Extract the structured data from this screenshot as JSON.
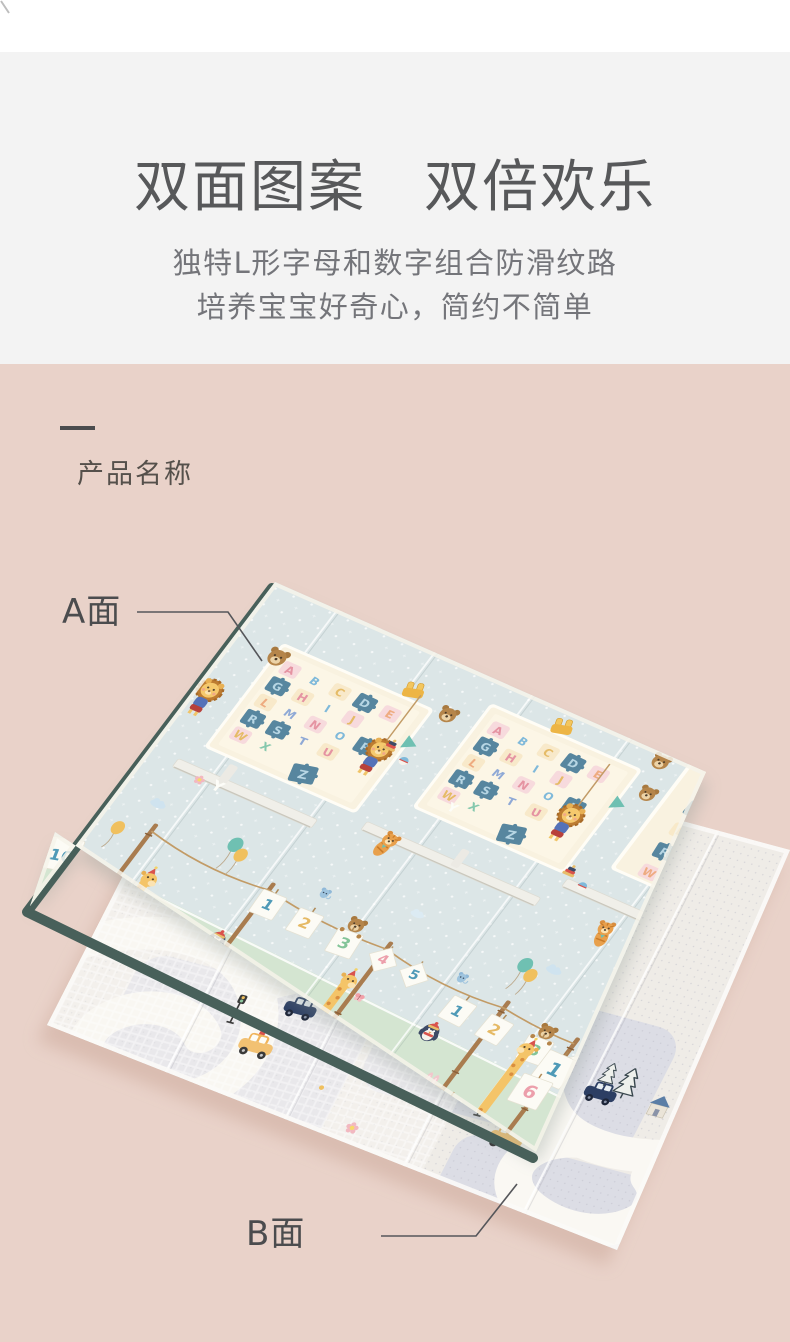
{
  "colors": {
    "page_top": "#ffffff",
    "band_gray": "#f3f3f3",
    "band_pink": "#e9d2c9",
    "title_text": "#57585a",
    "subtitle_text": "#74757a",
    "section_text": "#55504b",
    "label_text": "#4b4c4e",
    "pointer_line": "#55565a"
  },
  "header": {
    "title": "双面图案　双倍欢乐",
    "subtitle1": "独特L形字母和数字组合防滑纹路",
    "subtitle2": "培养宝宝好奇心，简约不简单"
  },
  "section": {
    "label": "产品名称"
  },
  "product": {
    "side_a_label": "A面",
    "side_b_label": "B面"
  },
  "mat_a": {
    "base_color": "#dce6e7",
    "ground_color": "#d4e5d1",
    "panel_color": "#f9f2e0",
    "panel_inner_color": "#fcf6e6",
    "edge_color": "#48605a",
    "pole_color": "#a97c4f",
    "rope_color": "#c29b66",
    "alphabet_rows": [
      [
        "A",
        "B",
        "C",
        "D",
        "E"
      ],
      [
        "G",
        "H",
        "I",
        "J"
      ],
      [
        "L",
        "M",
        "N",
        "O",
        "P"
      ],
      [
        "R",
        "S",
        "T",
        "U"
      ],
      [
        "W",
        "X"
      ]
    ],
    "letter_y": "Y",
    "letter_z": "Z",
    "side_panel_letters": [
      "A",
      "G",
      "L",
      "R",
      "W"
    ],
    "puzzle_letters": [
      "D",
      "G",
      "S",
      "P",
      "Z",
      "R"
    ],
    "upper_numbers": [
      "1",
      "2",
      "3",
      "4",
      "5"
    ],
    "lower_numbers": [
      "6",
      "7",
      "8",
      "9",
      "10"
    ],
    "corner_numbers": [
      "10",
      "1",
      "6"
    ],
    "number_colors": {
      "1": "#4f9ab7",
      "2": "#e5b964",
      "3": "#83c498",
      "4": "#ec9fab",
      "5": "#4f9ab7",
      "6": "#ec9fab",
      "7": "#83c498",
      "8": "#e5b964",
      "9": "#93cfc0",
      "10": "#4f9ab7"
    },
    "letter_palette": [
      "#e593a2",
      "#7fb9da",
      "#e5bb66",
      "#85c8ad",
      "#eeab80",
      "#8fa9d6"
    ],
    "tile_palette": [
      "#f6d7dc",
      "#d7ebf4",
      "#f7e8c6",
      "#def0e3"
    ],
    "puzzle_tile_color": "#57869f",
    "puzzle_letter_color": "#b7d6e4",
    "animals": [
      "lion",
      "giraffe",
      "penguin",
      "bear",
      "tiger",
      "rabbit",
      "mouse",
      "cat",
      "dog",
      "frog",
      "butterfly"
    ]
  },
  "mat_b": {
    "base_color": "#efece7",
    "patch_color": "#dcdde5",
    "road_color": "#faf8f3",
    "elements": [
      "taxi",
      "navy-car",
      "traffic-light",
      "pine-tree",
      "house",
      "cloud",
      "striped-awning"
    ]
  }
}
